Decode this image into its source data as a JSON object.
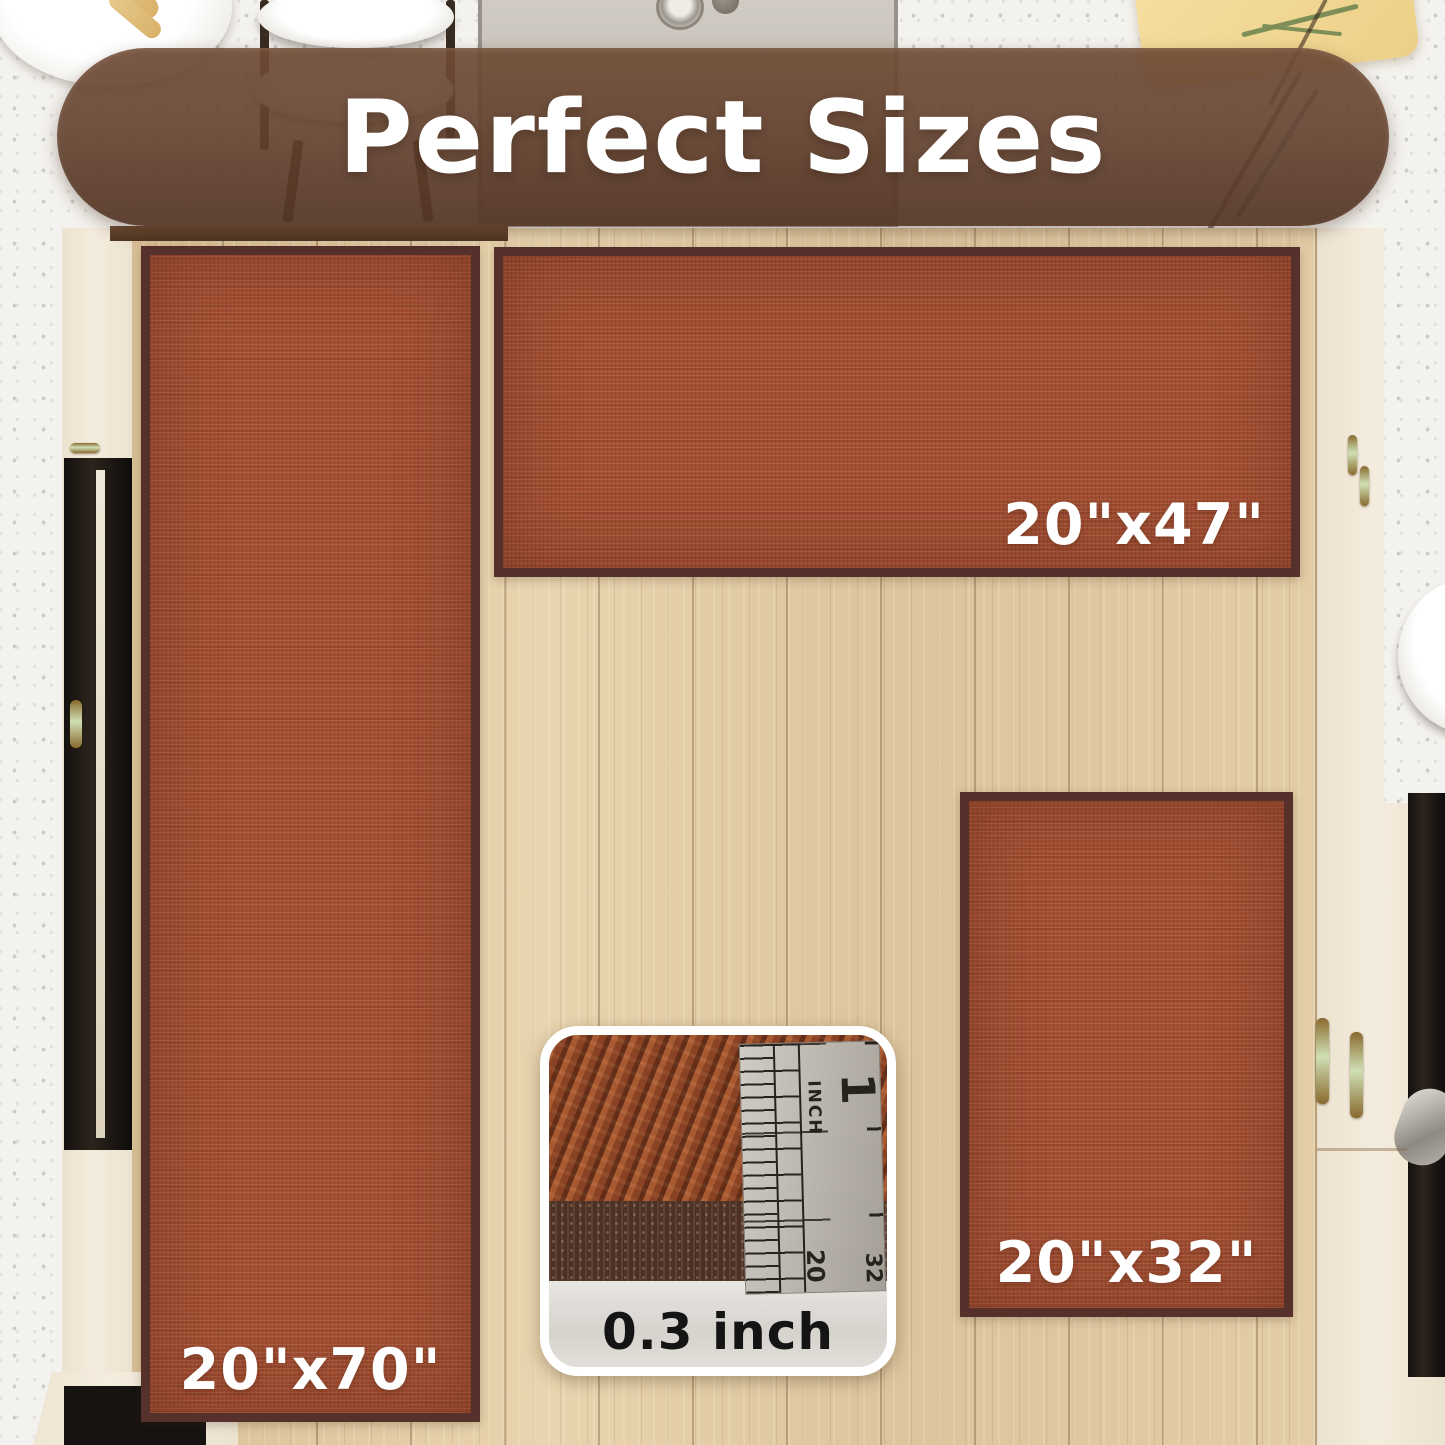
{
  "banner": {
    "title": "Perfect Sizes"
  },
  "rugs": {
    "runner": {
      "size_label": "20\"x70\""
    },
    "wide": {
      "size_label": "20\"x47\""
    },
    "small": {
      "size_label": "20\"x32\""
    }
  },
  "inset": {
    "thickness_label": "0.3 inch",
    "ruler": {
      "inch_number": "1",
      "inch_unit": "INCH",
      "mark_20": "20",
      "mark_32": "32"
    }
  },
  "colors": {
    "banner_brown": "#6b4a35",
    "rug_rust": "#a24f33",
    "rug_border": "#56312b",
    "floor_wood": "#e0c8a1",
    "cabinet_cream": "#f0e8d8",
    "label_white": "#ffffff",
    "thickness_text": "#141414"
  }
}
